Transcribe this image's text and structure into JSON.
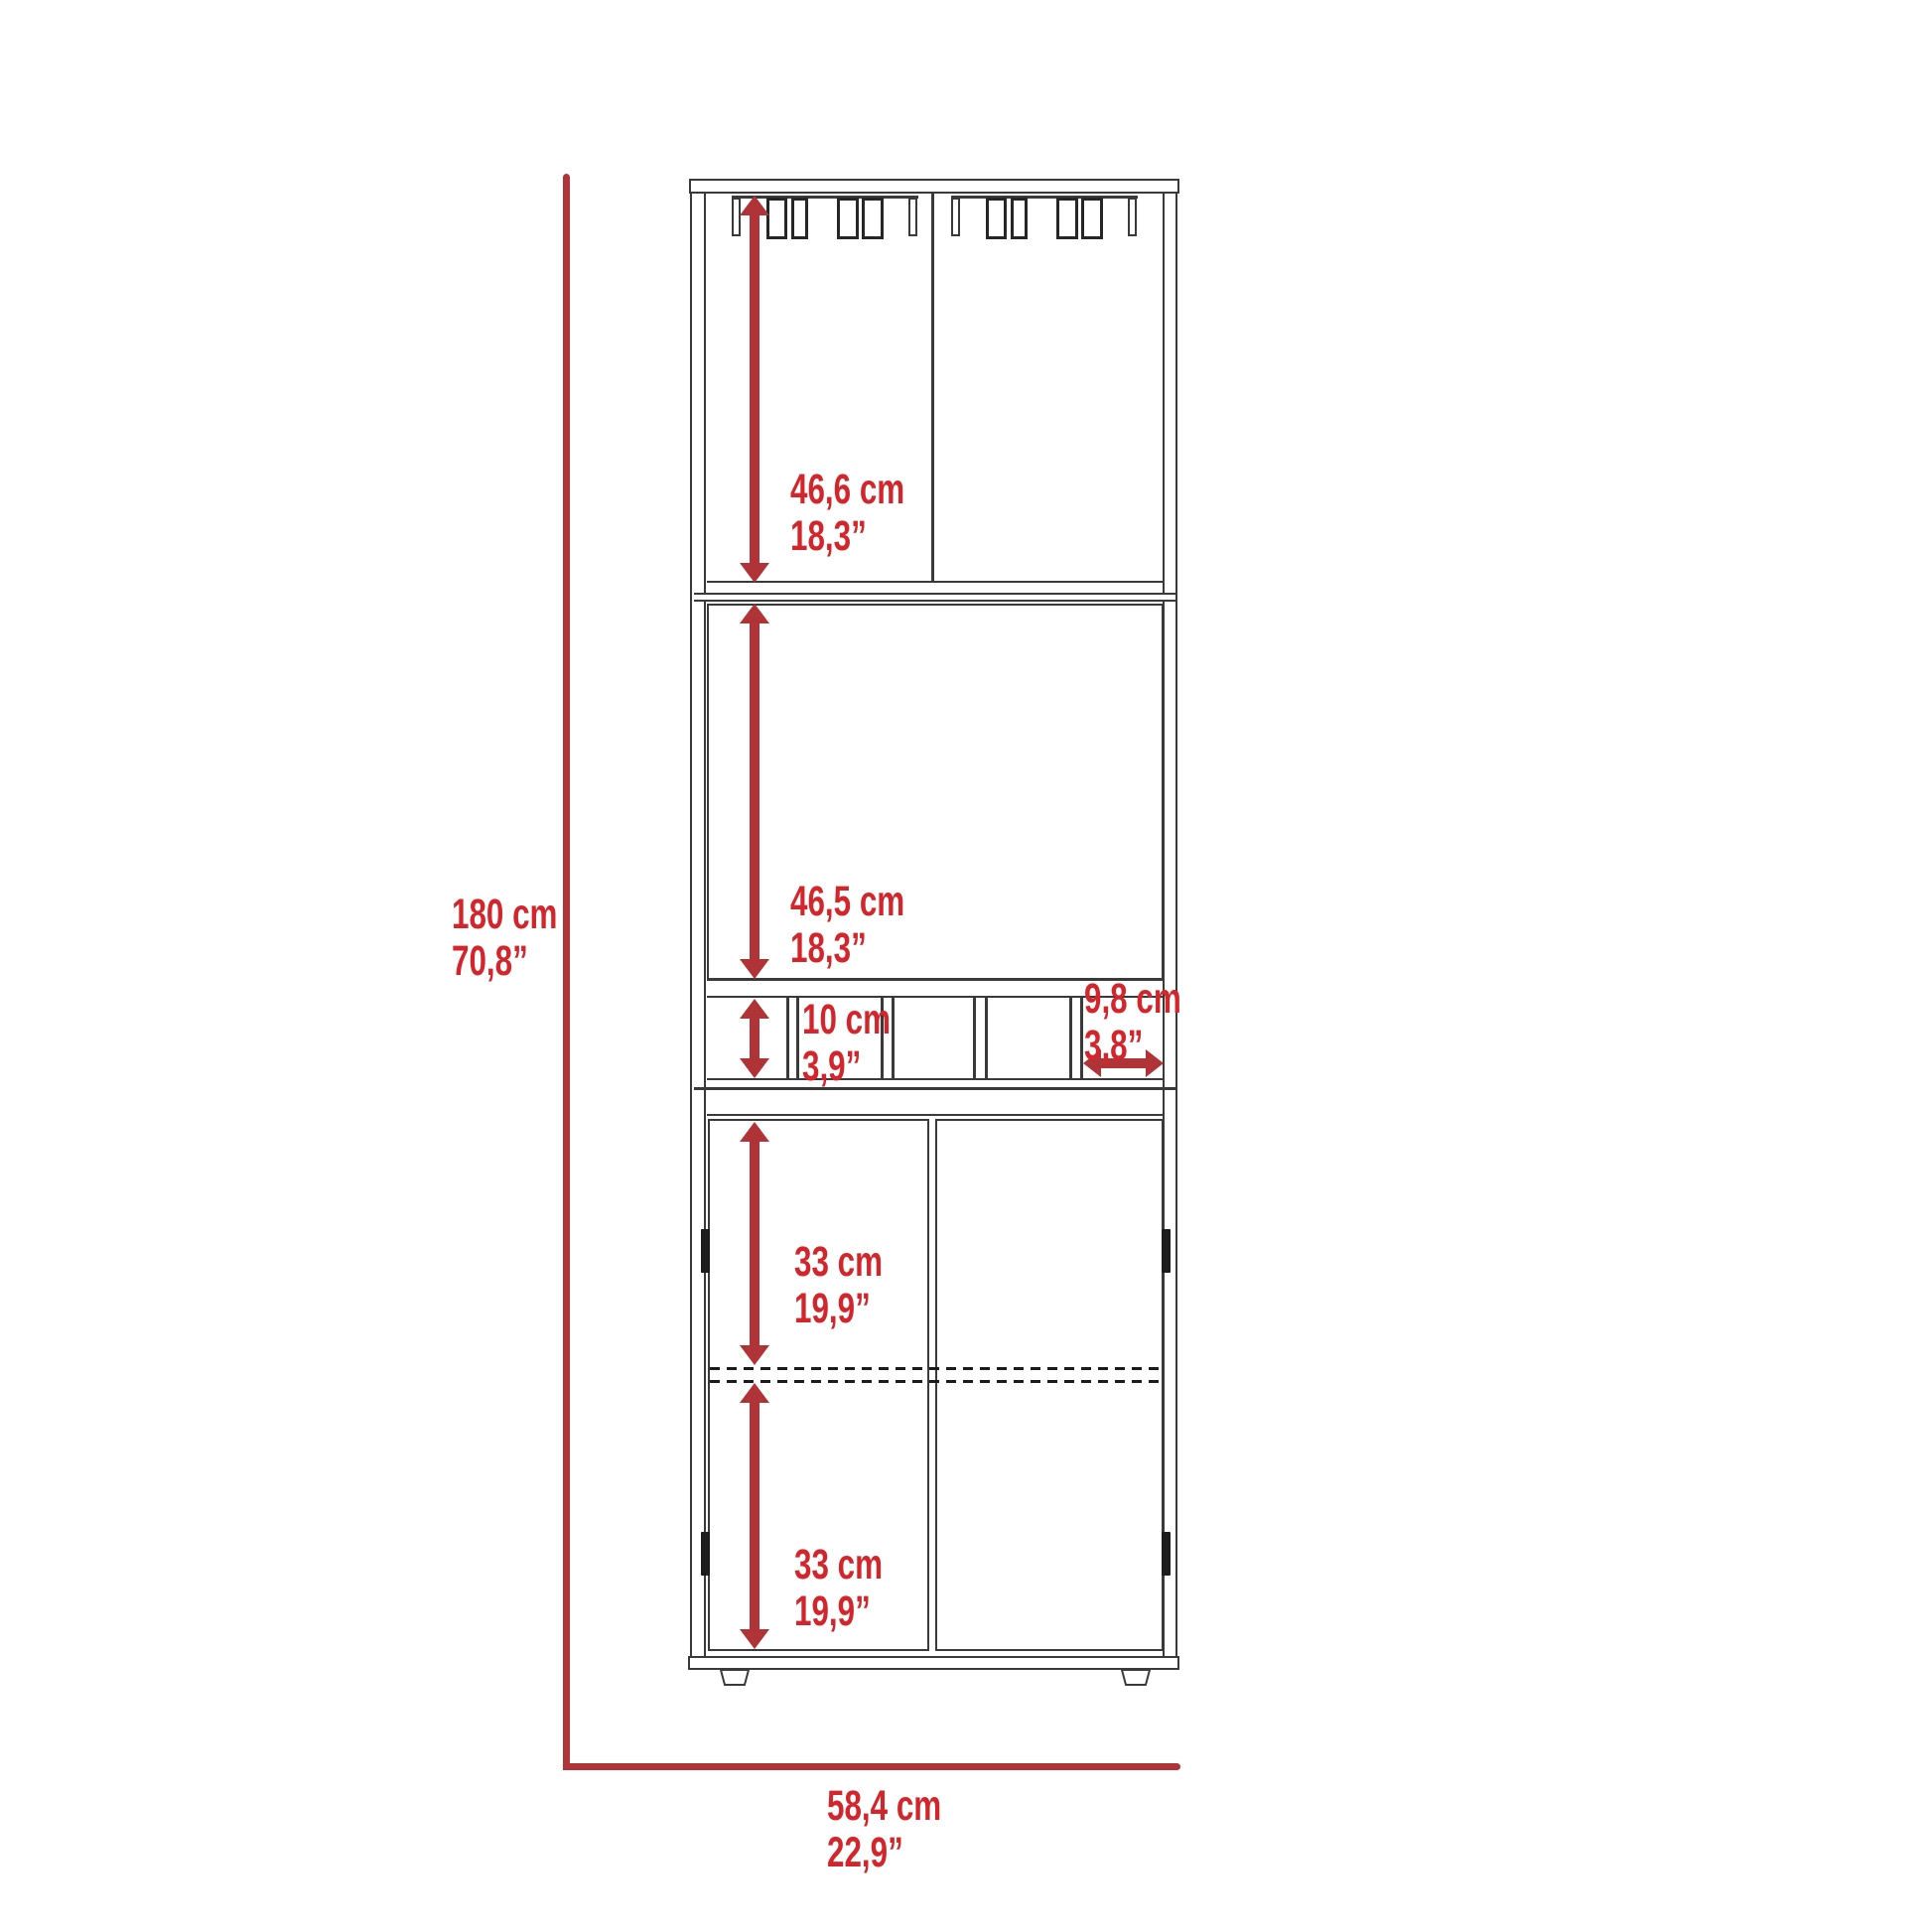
{
  "diagram": {
    "type": "furniture-dimension-diagram",
    "subject": "tall bar cabinet with stemware rack, open shelf, bottle cubbies and double doors",
    "units": [
      "cm",
      "inches"
    ]
  },
  "dims": {
    "height": {
      "cm": "180 cm",
      "in": "70,8”"
    },
    "width": {
      "cm": "58,4 cm",
      "in": "22,9”"
    },
    "glass_rack_section": {
      "cm": "46,6 cm",
      "in": "18,3”"
    },
    "open_shelf_section": {
      "cm": "46,5 cm",
      "in": "18,3”"
    },
    "cubby_height": {
      "cm": "10 cm",
      "in": "3,9”"
    },
    "cubby_width": {
      "cm": "9,8 cm",
      "in": "3,8”"
    },
    "upper_door_section": {
      "cm": "33 cm",
      "in": "19,9”"
    },
    "lower_door_section": {
      "cm": "33 cm",
      "in": "19,9”"
    }
  },
  "colors": {
    "label_red": "#d2262c",
    "dimension_line_red": "#b03338",
    "drawing_line": "#3a3a3a",
    "background": "#ffffff"
  }
}
